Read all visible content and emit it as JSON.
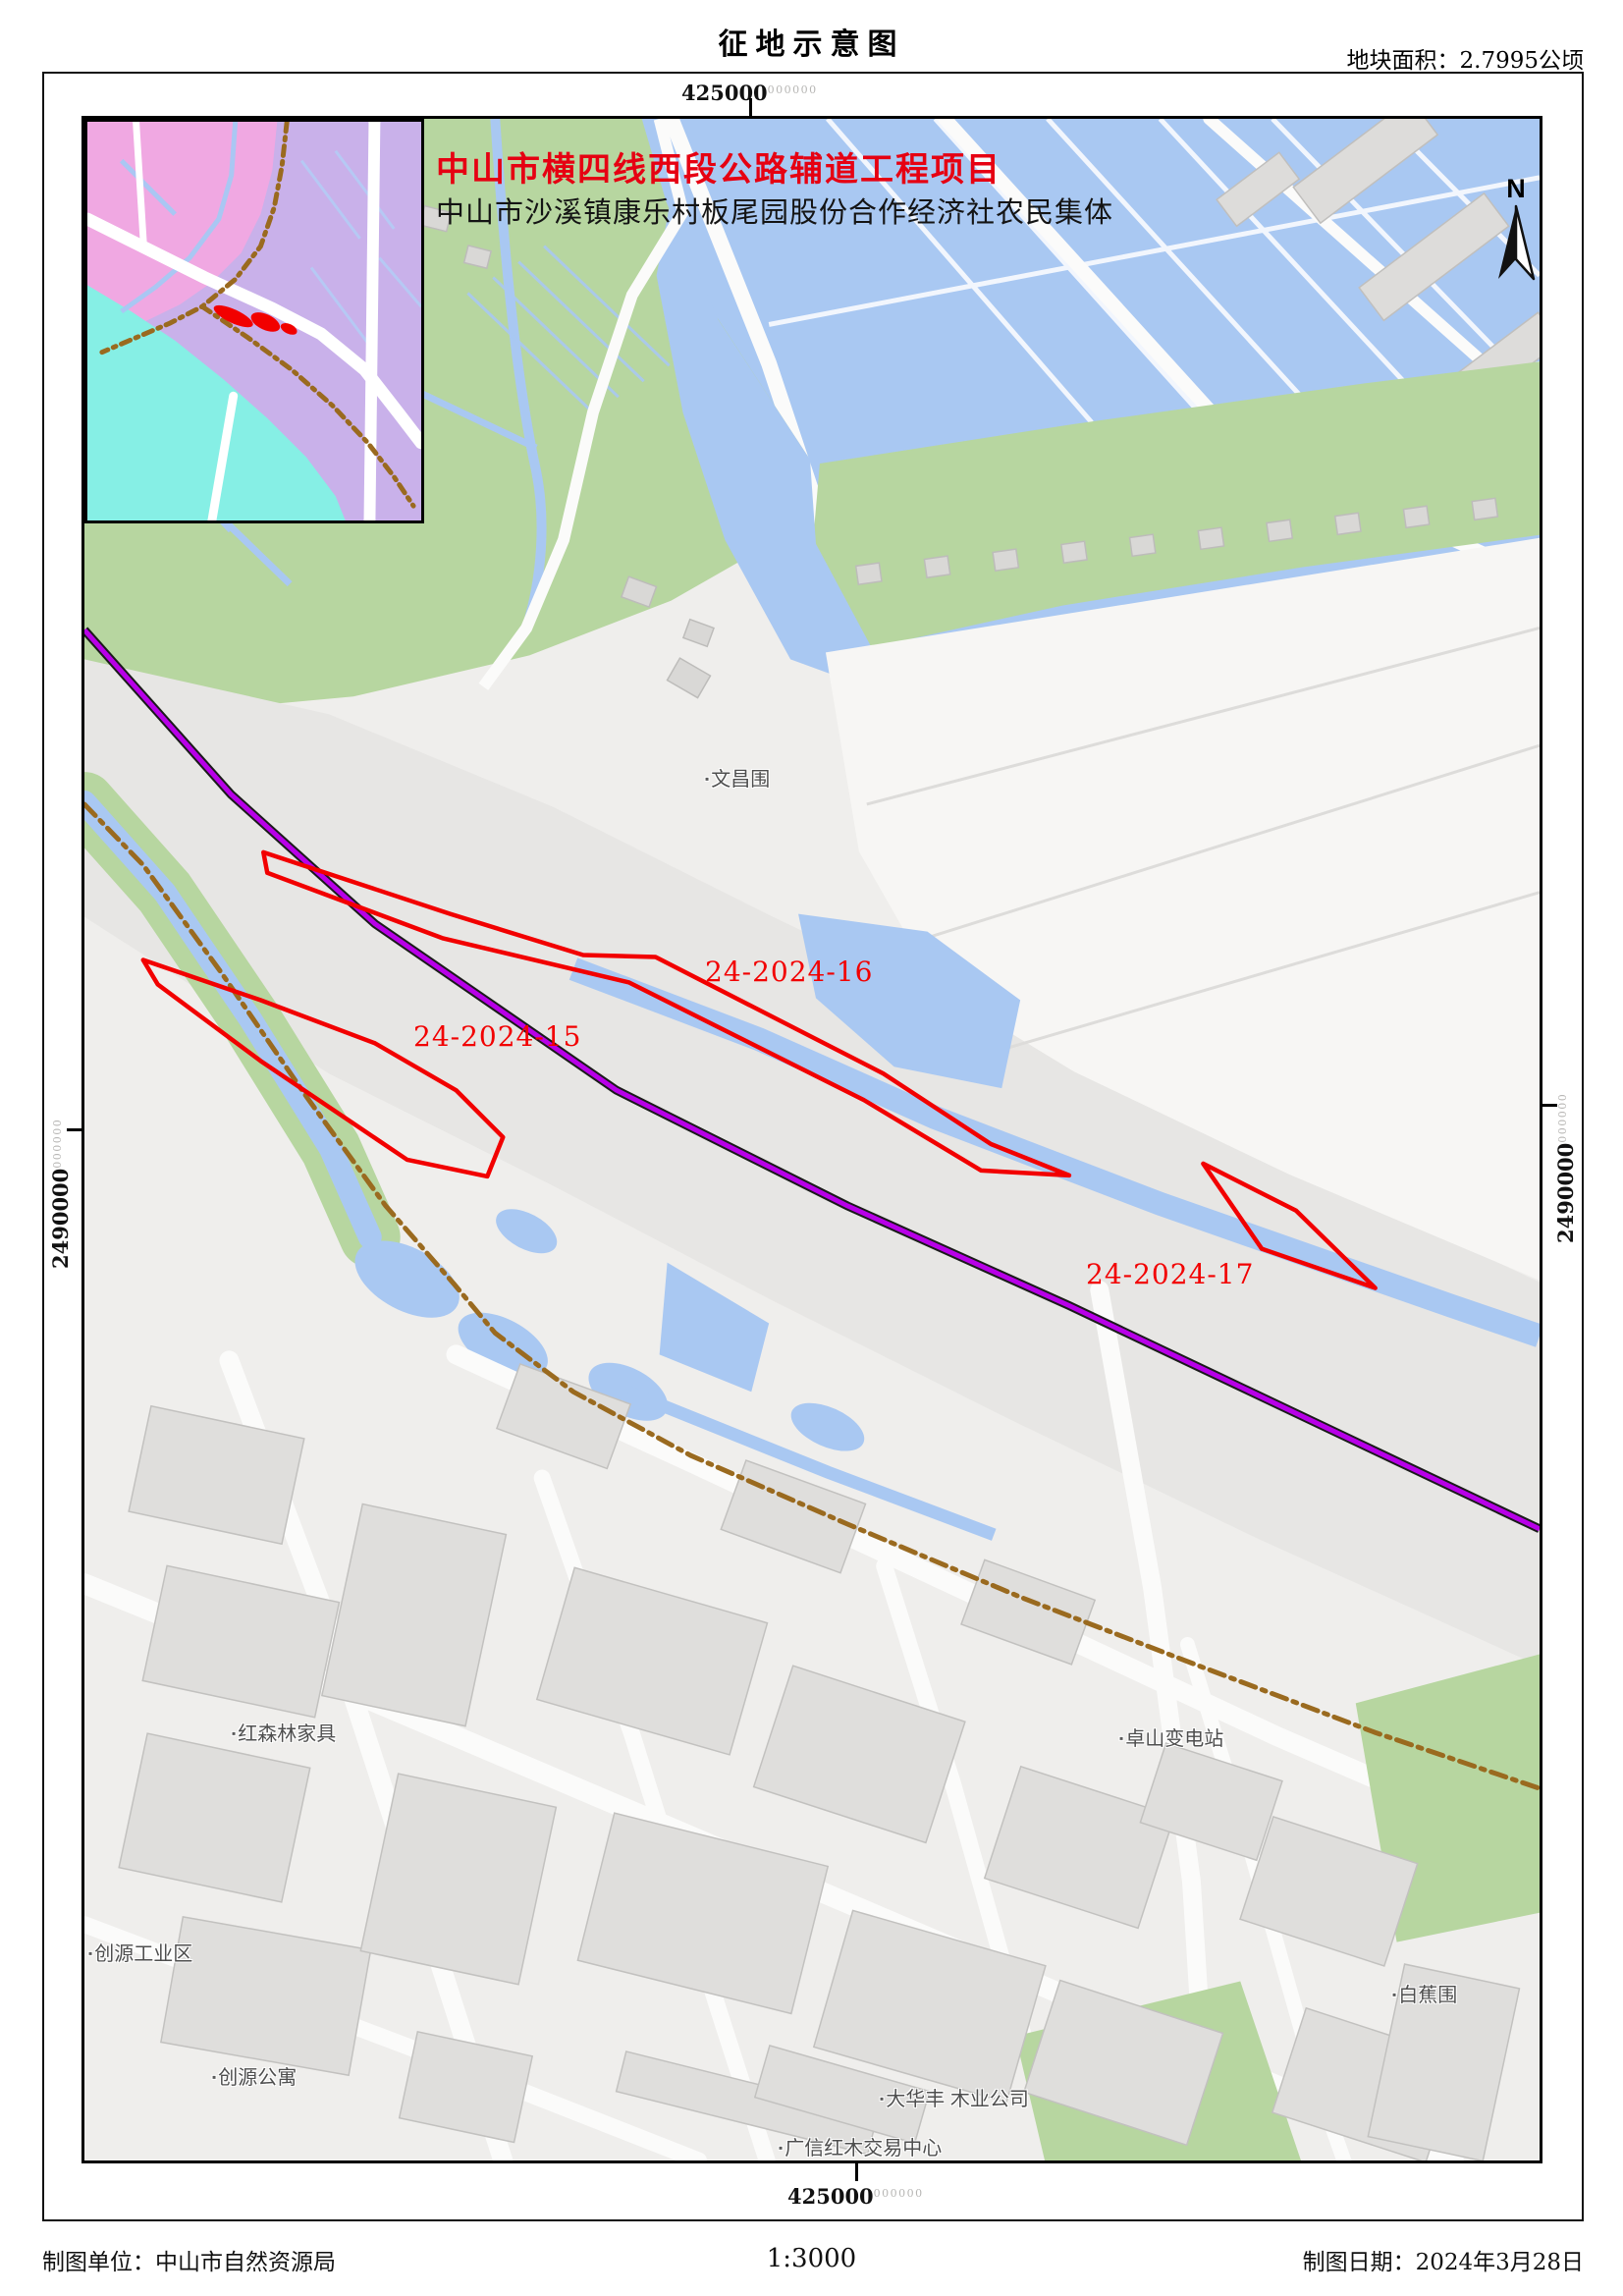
{
  "header": {
    "title": "征地示意图",
    "area_label": "地块面积：2.7995公顷"
  },
  "map": {
    "project_title": "中山市横四线西段公路辅道工程项目",
    "project_subtitle": "中山市沙溪镇康乐村板尾园股份合作经济社农民集体",
    "north_label": "N",
    "grid": {
      "top": {
        "value": "425000",
        "sup": "000000"
      },
      "bottom": {
        "value": "425000",
        "sup": "000000"
      },
      "left": {
        "value": "2490000",
        "sup": "000000"
      },
      "right": {
        "value": "2490000",
        "sup": "000000"
      }
    },
    "parcels": [
      {
        "id": "24-2024-15"
      },
      {
        "id": "24-2024-16"
      },
      {
        "id": "24-2024-17"
      }
    ],
    "places": [
      {
        "name": "文昌围"
      },
      {
        "name": "红森林家具"
      },
      {
        "name": "卓山变电站"
      },
      {
        "name": "创源工业区"
      },
      {
        "name": "创源公寓"
      },
      {
        "name": "白蕉围"
      },
      {
        "name": "大华丰 木业公司"
      },
      {
        "name": "广信红木交易中心"
      }
    ]
  },
  "footer": {
    "agency": "制图单位：中山市自然资源局",
    "scale": "1:3000",
    "date": "制图日期：2024年3月28日"
  },
  "icons": {
    "poi_marker": "▪"
  },
  "colors": {
    "parcel_red": "#f20000",
    "project_title_red": "#e60012",
    "road_purple": "#b800e8",
    "farmland_green": "#b7d6a0",
    "water_blue": "#a9c8f2",
    "boundary_brown": "#9a6a1f",
    "urban_gray": "#e7e6e4",
    "inset_pink": "#f0a8e2",
    "inset_lavender": "#c9b1ea",
    "inset_cyan": "#86efe5"
  }
}
